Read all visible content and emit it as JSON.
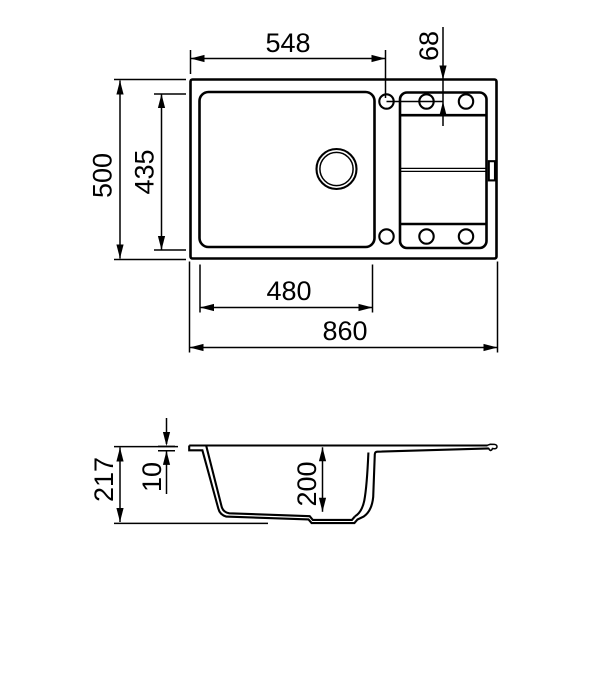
{
  "drawing": {
    "type": "sink-technical-drawing",
    "background_color": "#ffffff",
    "line_color": "#000000",
    "top_view": {
      "dims": {
        "tap_center_from_left": "548",
        "tap_center_from_back": "68",
        "overall_depth": "500",
        "bowl_front_to_back": "435",
        "bowl_width": "480",
        "overall_width": "860"
      }
    },
    "side_view": {
      "dims": {
        "total_height": "217",
        "rim_thickness": "10",
        "bowl_depth": "200"
      }
    }
  }
}
